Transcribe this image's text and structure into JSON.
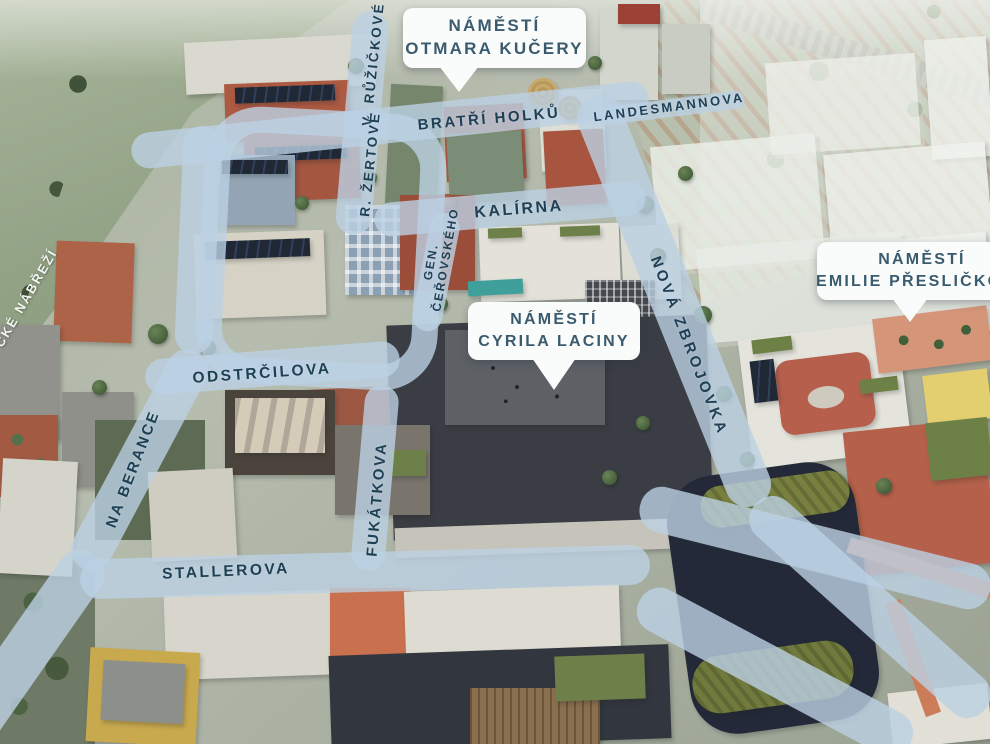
{
  "map": {
    "description": "Aerial masterplan rendering with street-name overlay labels",
    "palette": {
      "road_overlay": "#bcd1e3",
      "street_label_text": "#1f4054",
      "street_label_light": "#f2f4f0",
      "bubble_background": "#fafbfb",
      "bubble_text": "#3a5b6e",
      "river": "#53624c",
      "fields": "#9fae92",
      "brick_building": "#ad5a43",
      "navy_building": "#232938",
      "factory_hall": "#3a3e44",
      "green_roof": "#6e8049",
      "terracotta_path": "#cd7c59"
    },
    "squares": [
      {
        "id": "otmara-kucery",
        "line1": "NÁMĚSTÍ",
        "line2": "OTMARA KUČERY"
      },
      {
        "id": "cyrila-laciny",
        "line1": "NÁMĚSTÍ",
        "line2": "CYRILA LACINY"
      },
      {
        "id": "emilie-preslickove",
        "line1": "NÁMĚSTÍ",
        "line2": "EMILIE PŘESLIČKOVÉ"
      }
    ],
    "streets": [
      {
        "id": "bratri-holku",
        "label": "BRATŘÍ HOLKŮ"
      },
      {
        "id": "landesmannova",
        "label": "LANDESMANNOVA"
      },
      {
        "id": "v-ruzickove",
        "label": "V. RŮŽIČKOVÉ"
      },
      {
        "id": "r-zertove",
        "label": "R. ŽERTOVÉ"
      },
      {
        "id": "kalirna",
        "label": "KALÍRNA"
      },
      {
        "id": "gen-cerovskeho",
        "label": "GEN. ČEŘOVSKÉHO"
      },
      {
        "id": "nova-zbrojovka",
        "label": "NOVÁ ZBROJOVKA"
      },
      {
        "id": "odstrcilova",
        "label": "ODSTRČILOVA"
      },
      {
        "id": "na-berance",
        "label": "NA BERANCE"
      },
      {
        "id": "fukatkova",
        "label": "FUKÁTKOVA"
      },
      {
        "id": "stallerova",
        "label": "STALLEROVA"
      },
      {
        "id": "nabrezi-partial",
        "label": "CKÉ NÁBŘEŽÍ"
      }
    ]
  }
}
